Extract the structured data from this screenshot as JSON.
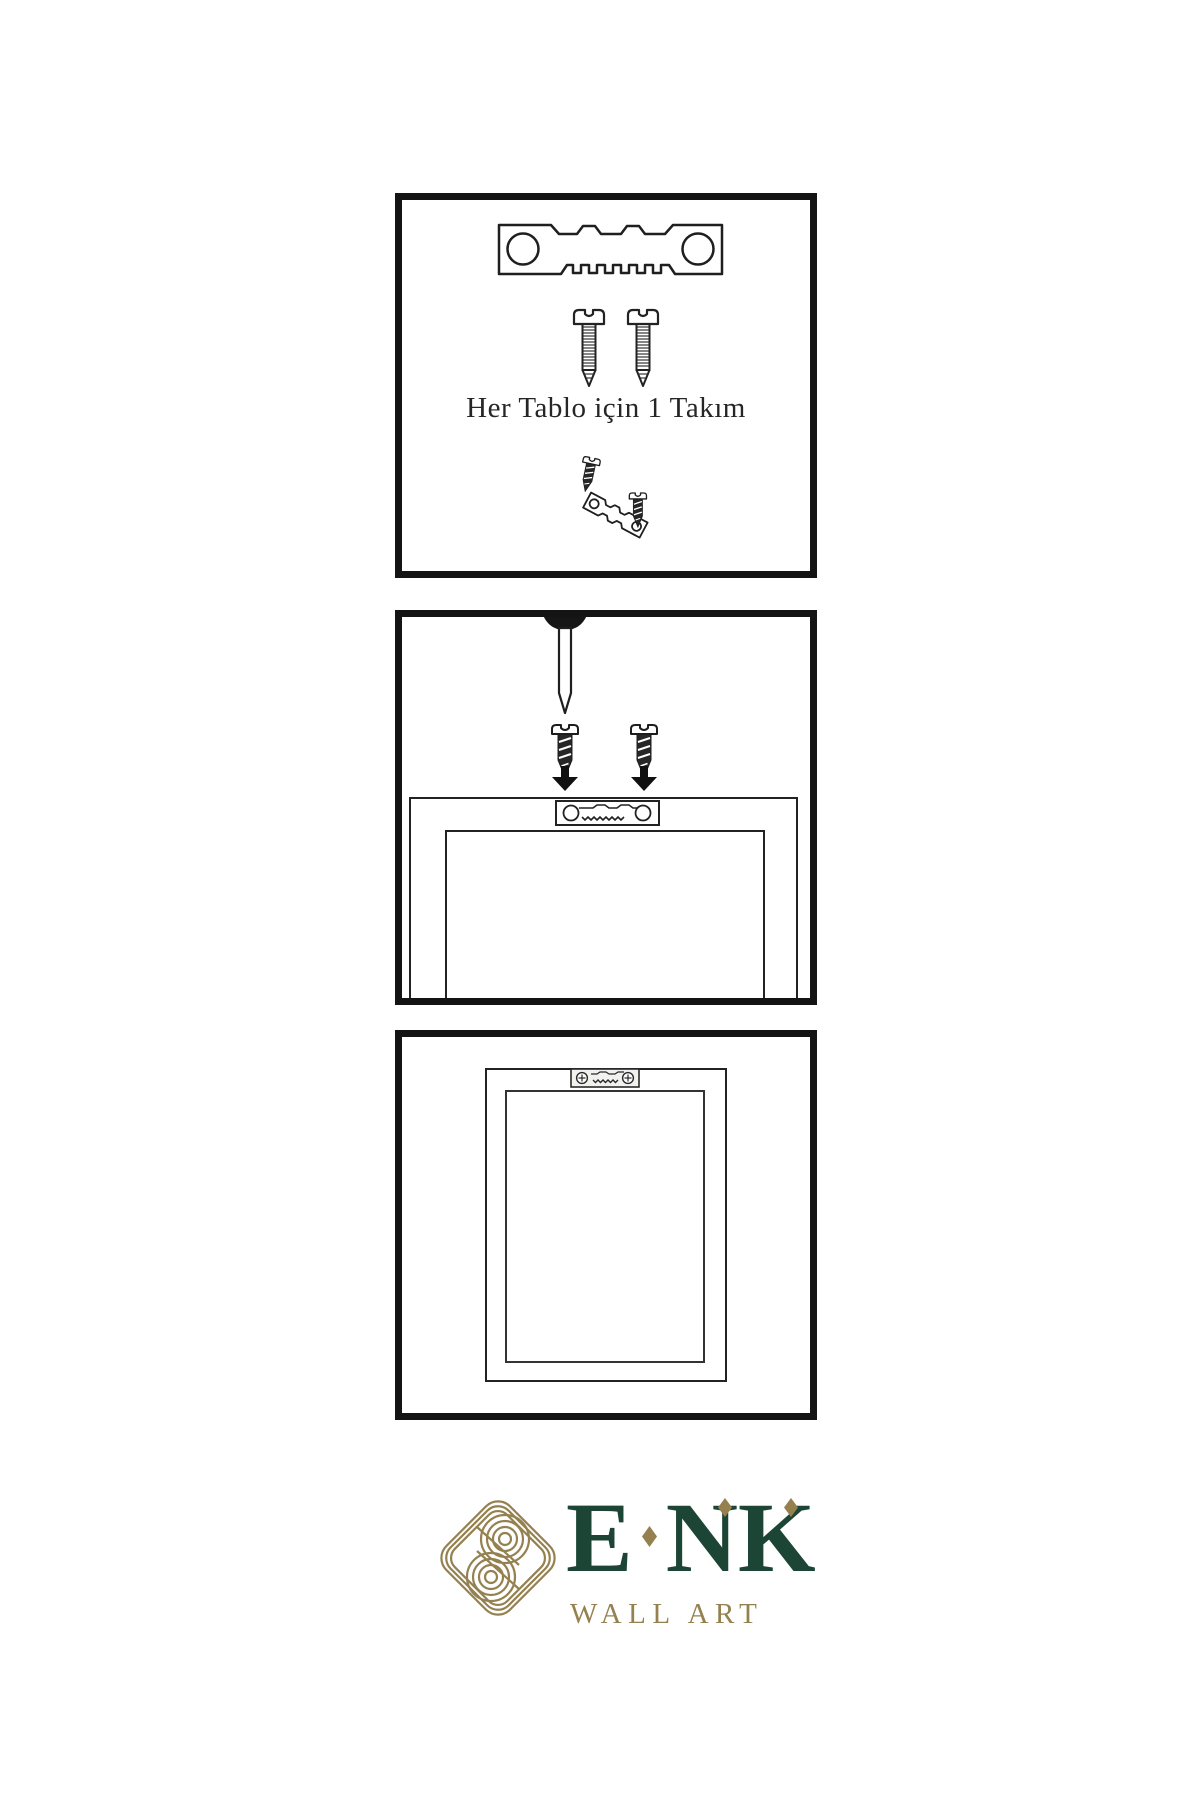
{
  "caption": "Her Tablo için 1 Takım",
  "brand": {
    "name_e": "E",
    "name_n": "N",
    "name_k": "K",
    "name": "ENK",
    "subtitle": "WALL ART"
  },
  "colors": {
    "background": "#ffffff",
    "ink": "#1f1f1f",
    "panel_border": "#141414",
    "brand_green": "#1d4536",
    "brand_gold": "#94814f"
  },
  "icons": {
    "panel1": [
      "sawtooth-hanger-icon",
      "screw-icon",
      "screw-icon",
      "screw-into-hanger-icon"
    ],
    "panel2": [
      "wall-nail-icon",
      "screw-icon",
      "screw-icon",
      "arrow-down-icon",
      "frame-back-with-hanger-icon"
    ],
    "panel3": [
      "mounted-frame-with-hanger-icon"
    ],
    "logo": "knot-logo-icon"
  }
}
